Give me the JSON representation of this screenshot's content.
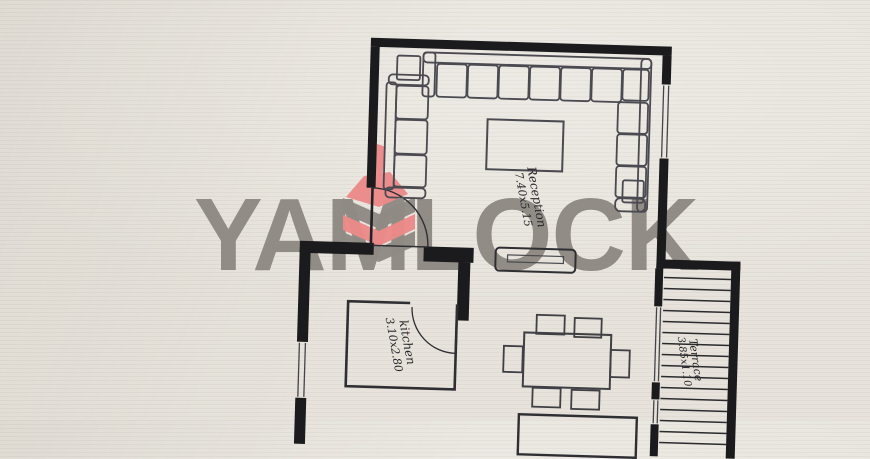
{
  "watermark": {
    "brand": "YAMLOCK",
    "logo_icon": "yamlock-cube-logo",
    "text_color": "#8a867f",
    "logo_red": "#ed8a8a",
    "logo_gray": "#8f8b84"
  },
  "rooms": {
    "reception": {
      "name": "Reception",
      "size": "7.40x5.15"
    },
    "kitchen": {
      "name": "kitchen",
      "size": "3.10x2.80"
    },
    "terrace": {
      "name": "Terrace",
      "size": "3.85x1.10"
    }
  },
  "plan": {
    "wall_color": "#1b1b1d",
    "line_color": "#4a4a50",
    "paper_color": "#e7e3dc",
    "furniture": [
      "sectional-sofa",
      "two-seat-sofa",
      "coffee-table",
      "tv-stand",
      "side-table",
      "dining-table",
      "dining-chair",
      "door-swing",
      "window",
      "terrace-decking"
    ]
  }
}
